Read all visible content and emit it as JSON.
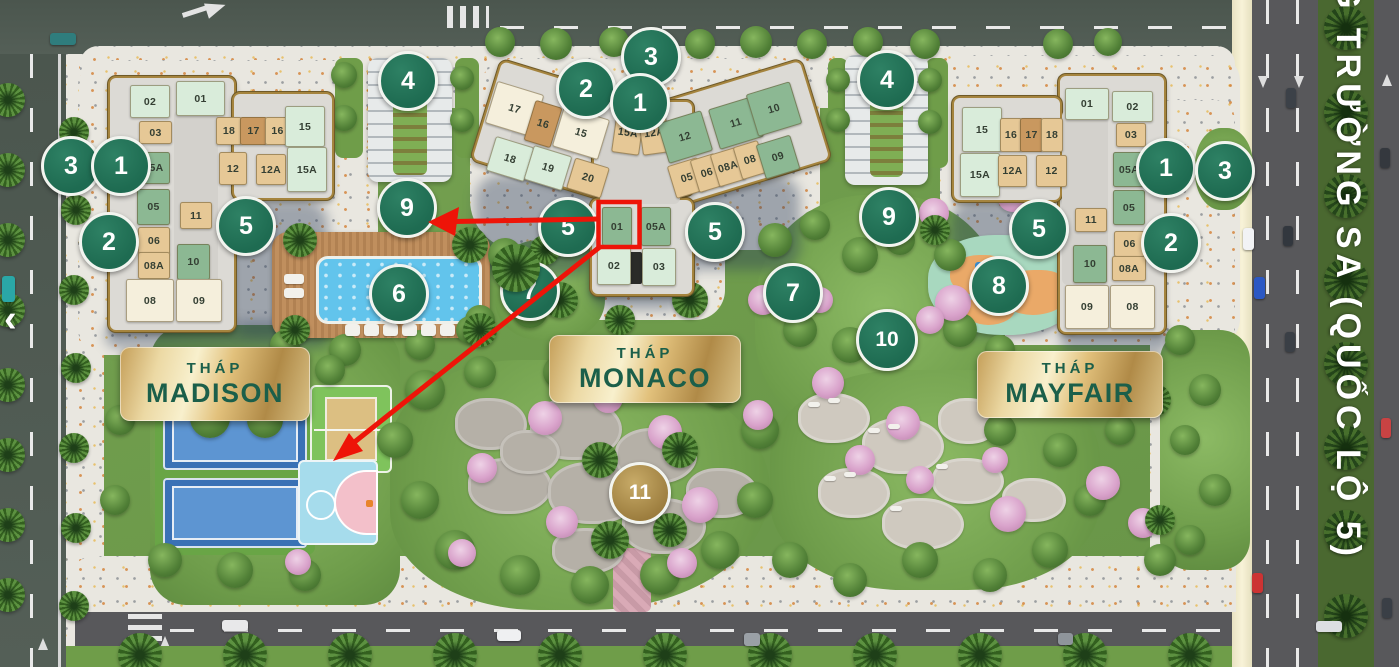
{
  "project": {
    "street": {
      "name": "G TRƯỜNG SA (QUỐC LỘ 5)"
    },
    "nav": {
      "prev_label": "‹"
    },
    "highlight": {
      "unit_label": "01",
      "tower": "monaco"
    },
    "colors": {
      "marker_green": "#1e6b51",
      "marker_green_hi": "#2e8164",
      "marker_gold": "#9b7c3d",
      "marker_gold_hi": "#c8ab68",
      "highlight_red": "#ee1408",
      "plaque_text": "#1b5f4a",
      "unit_mint": "#d9ecda",
      "unit_green": "#8cb893",
      "unit_tan": "#e6c896",
      "unit_brown": "#c9985f",
      "unit_cream": "#f5efdc"
    },
    "towers": [
      {
        "id": "madison",
        "plaque": {
          "x": 120,
          "y": 347,
          "w": 190,
          "h": 74,
          "line1": "THÁP",
          "line2": "MADISON"
        },
        "units": [
          [
            "02",
            130,
            85,
            38,
            31,
            "m",
            0
          ],
          [
            "01",
            176,
            81,
            47,
            33,
            "m",
            0
          ],
          [
            "03",
            139,
            121,
            31,
            21,
            "t",
            0
          ],
          [
            "18",
            216,
            117,
            24,
            26,
            "t",
            0
          ],
          [
            "17",
            240,
            117,
            25,
            26,
            "b",
            0
          ],
          [
            "16",
            265,
            117,
            23,
            26,
            "t",
            0
          ],
          [
            "15",
            285,
            106,
            38,
            39,
            "m",
            0
          ],
          [
            "05A",
            137,
            152,
            31,
            30,
            "g",
            0
          ],
          [
            "12",
            219,
            152,
            26,
            31,
            "t",
            0
          ],
          [
            "12A",
            256,
            154,
            28,
            29,
            "t",
            0
          ],
          [
            "15A",
            287,
            147,
            38,
            43,
            "m",
            0
          ],
          [
            "05",
            137,
            189,
            31,
            34,
            "g",
            0
          ],
          [
            "11",
            180,
            202,
            30,
            25,
            "t",
            0
          ],
          [
            "06",
            138,
            227,
            30,
            26,
            "t",
            0
          ],
          [
            "10",
            177,
            244,
            31,
            34,
            "g",
            0
          ],
          [
            "08A",
            138,
            252,
            30,
            25,
            "t",
            0
          ],
          [
            "08",
            126,
            279,
            46,
            41,
            "c",
            0
          ],
          [
            "09",
            176,
            279,
            44,
            41,
            "c",
            0
          ]
        ]
      },
      {
        "id": "monaco",
        "plaque": {
          "x": 549,
          "y": 335,
          "w": 192,
          "h": 68,
          "line1": "THÁP",
          "line2": "MONACO"
        },
        "units": [
          [
            "17",
            490,
            87,
            47,
            42,
            "c",
            17
          ],
          [
            "16",
            529,
            103,
            26,
            40,
            "b",
            17
          ],
          [
            "15",
            557,
            112,
            46,
            40,
            "c",
            17
          ],
          [
            "15A",
            614,
            111,
            26,
            41,
            "t",
            8
          ],
          [
            "12A",
            640,
            111,
            26,
            41,
            "t",
            -8
          ],
          [
            "12",
            662,
            116,
            44,
            40,
            "g",
            -17
          ],
          [
            "11",
            713,
            102,
            44,
            40,
            "g",
            -17
          ],
          [
            "10",
            751,
            87,
            44,
            42,
            "g",
            -17
          ],
          [
            "18",
            490,
            141,
            38,
            34,
            "m",
            17
          ],
          [
            "19",
            528,
            150,
            38,
            34,
            "m",
            17
          ],
          [
            "20",
            570,
            162,
            34,
            30,
            "t",
            17
          ],
          [
            "05",
            671,
            161,
            30,
            32,
            "t",
            -17
          ],
          [
            "06",
            694,
            156,
            24,
            32,
            "t",
            -17
          ],
          [
            "08A",
            714,
            150,
            26,
            32,
            "t",
            -17
          ],
          [
            "08",
            737,
            143,
            24,
            32,
            "t",
            -17
          ],
          [
            "09",
            760,
            139,
            34,
            34,
            "g",
            -17
          ],
          [
            "01",
            602,
            207,
            28,
            37,
            "g",
            0
          ],
          [
            "05A",
            641,
            207,
            28,
            37,
            "g",
            0
          ],
          [
            "02",
            597,
            247,
            32,
            36,
            "m",
            0
          ],
          [
            "03",
            642,
            248,
            32,
            36,
            "m",
            0
          ]
        ]
      },
      {
        "id": "mayfair",
        "plaque": {
          "x": 977,
          "y": 351,
          "w": 186,
          "h": 67,
          "line1": "THÁP",
          "line2": "MAYFAIR"
        },
        "units": [
          [
            "01",
            1065,
            88,
            42,
            30,
            "m",
            0
          ],
          [
            "02",
            1112,
            91,
            39,
            29,
            "m",
            0
          ],
          [
            "15",
            962,
            107,
            38,
            43,
            "m",
            0
          ],
          [
            "16",
            1000,
            118,
            20,
            32,
            "t",
            0
          ],
          [
            "17",
            1020,
            118,
            21,
            32,
            "b",
            0
          ],
          [
            "18",
            1041,
            118,
            20,
            32,
            "t",
            0
          ],
          [
            "03",
            1116,
            123,
            28,
            22,
            "t",
            0
          ],
          [
            "15A",
            960,
            153,
            38,
            42,
            "m",
            0
          ],
          [
            "12A",
            998,
            155,
            27,
            30,
            "t",
            0
          ],
          [
            "12",
            1036,
            155,
            29,
            30,
            "t",
            0
          ],
          [
            "05A",
            1113,
            152,
            30,
            33,
            "g",
            0
          ],
          [
            "11",
            1075,
            208,
            30,
            22,
            "t",
            0
          ],
          [
            "05",
            1113,
            190,
            30,
            33,
            "g",
            0
          ],
          [
            "06",
            1114,
            231,
            29,
            24,
            "t",
            0
          ],
          [
            "10",
            1073,
            245,
            32,
            36,
            "g",
            0
          ],
          [
            "08A",
            1112,
            256,
            32,
            23,
            "t",
            0
          ],
          [
            "09",
            1065,
            285,
            42,
            42,
            "c",
            0
          ],
          [
            "08",
            1110,
            285,
            43,
            42,
            "c",
            0
          ]
        ]
      }
    ],
    "amenity_markers": [
      [
        "3",
        68,
        163
      ],
      [
        "1",
        118,
        163
      ],
      [
        "2",
        106,
        239
      ],
      [
        "5",
        243,
        223
      ],
      [
        "4",
        405,
        78
      ],
      [
        "9",
        404,
        205
      ],
      [
        "6",
        396,
        291
      ],
      [
        "7",
        527,
        288
      ],
      [
        "2",
        583,
        86
      ],
      [
        "3",
        648,
        54
      ],
      [
        "1",
        637,
        100
      ],
      [
        "5",
        565,
        224
      ],
      [
        "5",
        712,
        229
      ],
      [
        "7",
        790,
        290
      ],
      [
        "10",
        884,
        337
      ],
      [
        "8",
        996,
        283
      ],
      [
        "9",
        886,
        214
      ],
      [
        "4",
        884,
        77
      ],
      [
        "5",
        1036,
        226
      ],
      [
        "1",
        1163,
        165
      ],
      [
        "2",
        1168,
        240
      ],
      [
        "3",
        1222,
        168
      ],
      [
        "11",
        637,
        490,
        "gold"
      ]
    ]
  }
}
